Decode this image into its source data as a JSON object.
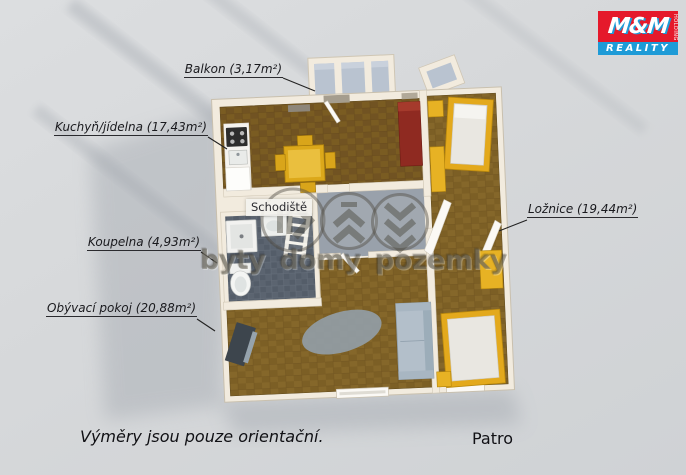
{
  "logo": {
    "brand": "M&M",
    "holding": "HOLDING",
    "division": "REALITY",
    "red": "#e5192b",
    "blue": "#1e9bd7"
  },
  "watermark": {
    "text": "byty domy pozemky"
  },
  "rooms": [
    {
      "id": "balkon",
      "label": "Balkon (3,17m²)"
    },
    {
      "id": "kuchyn",
      "label": "Kuchyň/jídelna (17,43m²)"
    },
    {
      "id": "schodiste",
      "label": "Schodiště"
    },
    {
      "id": "koupelna",
      "label": "Koupelna (4,93m²)"
    },
    {
      "id": "loznice",
      "label": "Ložnice (19,44m²)"
    },
    {
      "id": "obyvaci",
      "label": "Obývací pokoj (20,88m²)"
    }
  ],
  "captions": {
    "disclaimer": "Výměry jsou pouze orientační.",
    "floor": "Patro"
  },
  "colors": {
    "background": "#d6d8da",
    "wall": "#f2ebde",
    "wood_dark": "#7a5c22",
    "wood_light": "#85672a",
    "bath_tile": "#5b6470",
    "hall_floor": "#99a1ab",
    "balcony_floor": "#b9c3d0",
    "furniture_yellow": "#e3a91c",
    "wardrobe_red": "#8f2a21",
    "sofa_gray": "#b3bfca"
  }
}
